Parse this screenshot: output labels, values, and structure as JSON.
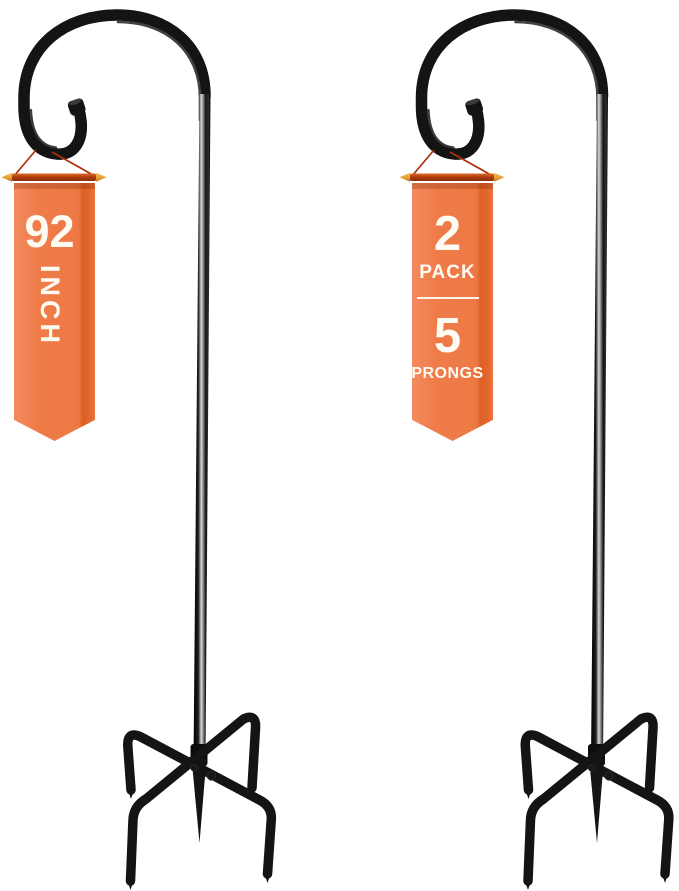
{
  "image_type": "product-photo",
  "scene": {
    "width_px": 679,
    "height_px": 891,
    "background": "#ffffff",
    "subject": "two black 5-prong shepherd hooks with orange pennant banners"
  },
  "banners": {
    "left": {
      "size_value": "92",
      "size_unit": "INCH"
    },
    "right": {
      "pack_count": "2",
      "pack_label": "PACK",
      "prong_count": "5",
      "prong_label": "PRONGS"
    }
  },
  "colors": {
    "banner_orange": "#ef7b48",
    "banner_highlight_orange": "#f28b5f",
    "banner_fold_orange": "#dd5f26",
    "bar_red": "#b23e0c",
    "string_red": "#a93108",
    "arrow_gold": "#e9a237",
    "text_white": "#fefbf3",
    "metal_black": "#141414",
    "metal_highlight": "#d9d9d9",
    "background_white": "#ffffff"
  }
}
